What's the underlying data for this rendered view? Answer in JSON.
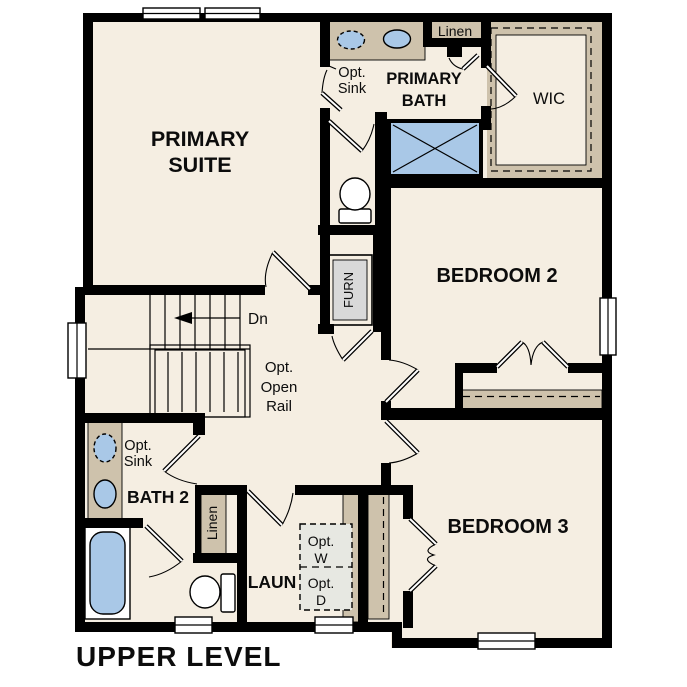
{
  "plan_title": "UPPER LEVEL",
  "rooms": {
    "primary_suite": {
      "line1": "PRIMARY",
      "line2": "SUITE"
    },
    "primary_bath": {
      "line1": "PRIMARY",
      "line2": "BATH"
    },
    "wic": {
      "label": "WIC"
    },
    "bedroom2": {
      "label": "BEDROOM 2"
    },
    "bedroom3": {
      "label": "BEDROOM 3"
    },
    "bath2": {
      "label": "BATH 2"
    },
    "laundry": {
      "label": "LAUN"
    },
    "furnace": {
      "label": "FURN"
    },
    "linen_upper": {
      "label": "Linen"
    },
    "linen_hall": {
      "label": "Linen"
    }
  },
  "annotations": {
    "opt_sink_primary": {
      "line1": "Opt.",
      "line2": "Sink"
    },
    "opt_sink_bath2": {
      "line1": "Opt.",
      "line2": "Sink"
    },
    "opt_open_rail": {
      "line1": "Opt.",
      "line2": "Open",
      "line3": "Rail"
    },
    "stairs_down": {
      "label": "Dn"
    },
    "opt_washer": {
      "line1": "Opt.",
      "line2": "W"
    },
    "opt_dryer": {
      "line1": "Opt.",
      "line2": "D"
    }
  },
  "colors": {
    "floor": "#f5eee2",
    "casework": "#cec2ac",
    "fixture_blue": "#a9c8e7",
    "wall": "#000000",
    "optional_appliance": "#e7e8e2",
    "furnace_fill": "#d9d9d9"
  }
}
